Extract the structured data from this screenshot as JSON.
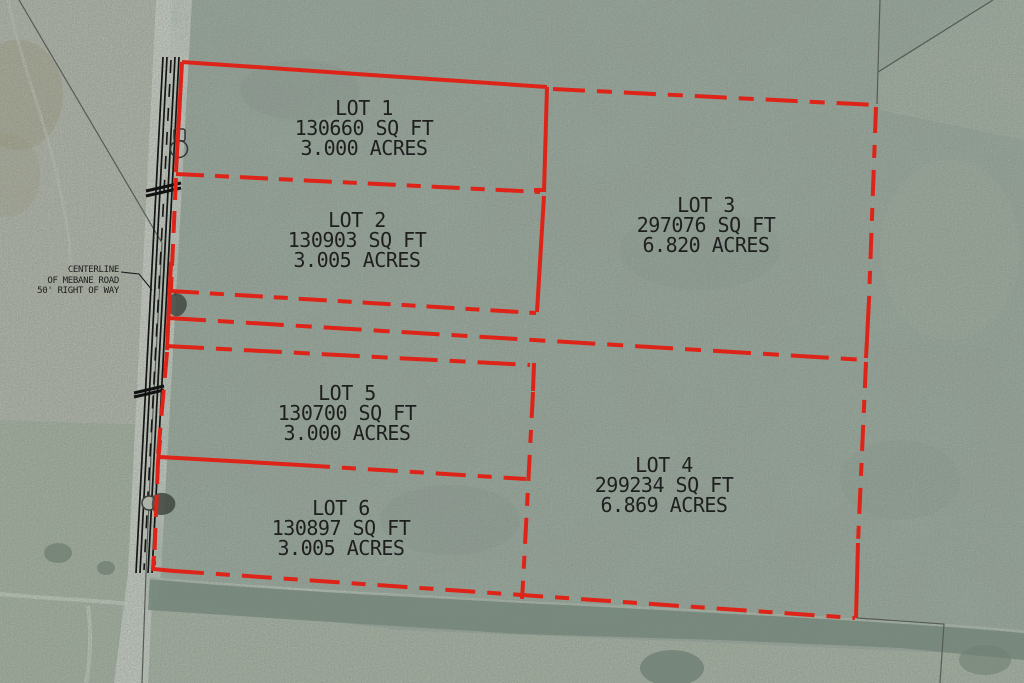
{
  "map": {
    "type": "plat-aerial-overlay",
    "road_label": {
      "line1": "CENTERLINE",
      "line2": "OF MEBANE ROAD",
      "line3": "50' RIGHT OF WAY"
    },
    "lots": [
      {
        "id": "lot-1",
        "name": "LOT 1",
        "sqft": "130660 SQ FT",
        "acres": "3.000 ACRES"
      },
      {
        "id": "lot-2",
        "name": "LOT 2",
        "sqft": "130903 SQ FT",
        "acres": "3.005 ACRES"
      },
      {
        "id": "lot-3",
        "name": "LOT 3",
        "sqft": "297076 SQ FT",
        "acres": "6.820 ACRES"
      },
      {
        "id": "lot-4",
        "name": "LOT 4",
        "sqft": "299234 SQ FT",
        "acres": "6.869 ACRES"
      },
      {
        "id": "lot-5",
        "name": "LOT 5",
        "sqft": "130700 SQ FT",
        "acres": "3.000 ACRES"
      },
      {
        "id": "lot-6",
        "name": "LOT 6",
        "sqft": "130897 SQ FT",
        "acres": "3.005 ACRES"
      }
    ],
    "icons": {
      "survey_marker": "survey-marker-icon",
      "culvert_crossing": "culvert-crossing-icon",
      "vegetation": "vegetation-icon",
      "structure": "structure-icon"
    },
    "colors": {
      "boundary_red": "#de2418",
      "road_line_black": "#151515",
      "survey_line_gray": "#565b56",
      "aerial_base_green": "#9aa69c",
      "field_tan": "#b3b5aa",
      "road_surface_gray": "#cbcfc6",
      "tree_band_green": "#77897c",
      "label_text": "#1e1f1e"
    }
  }
}
